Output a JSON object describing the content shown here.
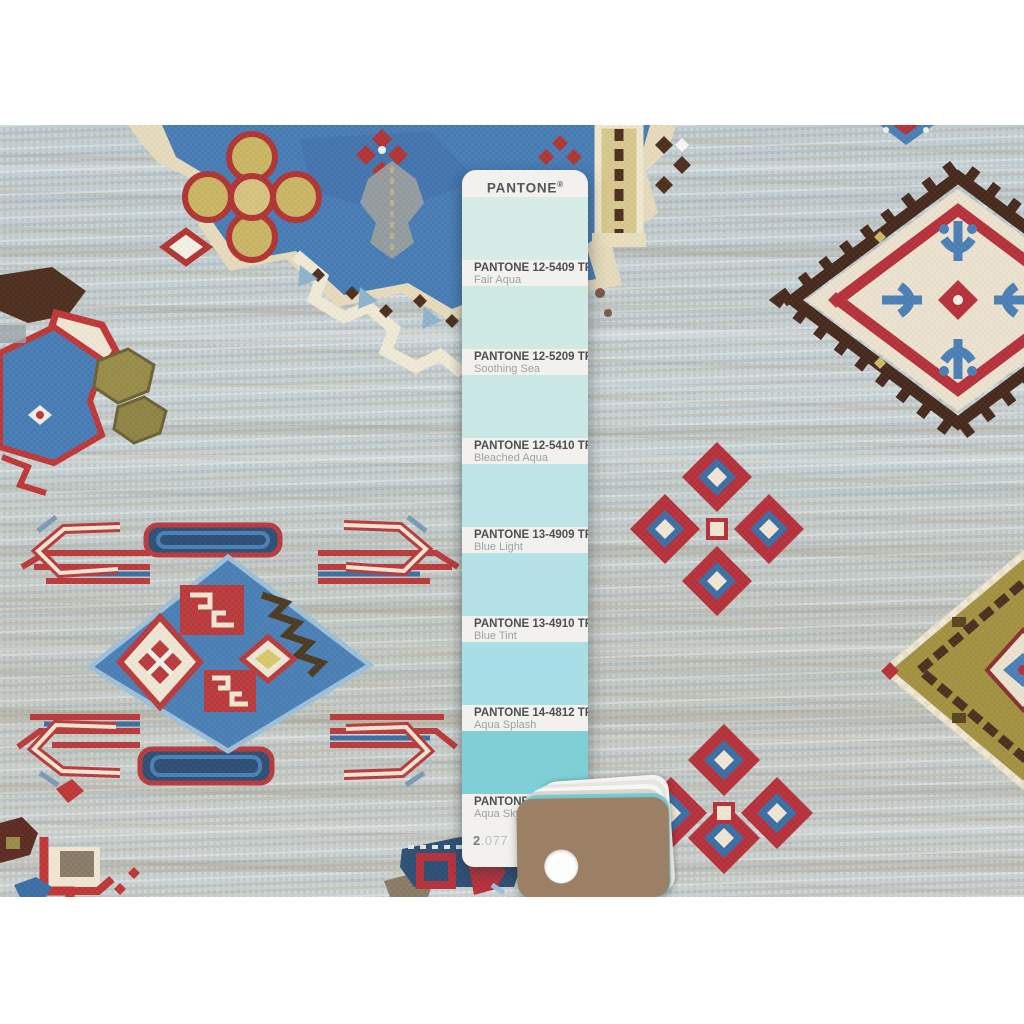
{
  "photo": {
    "subject_colors": {
      "rug_field": "#c6d0d2",
      "rug_blue": "#477cb4",
      "rug_navy": "#2d4e74",
      "rug_red": "#b5303a",
      "rug_cream": "#ece2cb",
      "rug_brown": "#4d2e1d",
      "rug_olive": "#a3913f",
      "rug_yellow": "#d0bb62"
    },
    "background_color": "#ffffff"
  },
  "pantone_card": {
    "brand": "PANTONE",
    "trademark": "®",
    "card_color": "#f2f1ee",
    "swatches": [
      {
        "code": "PANTONE 12-5409 TPG",
        "name": "Fair Aqua",
        "color": "#d7ece6"
      },
      {
        "code": "PANTONE 12-5209 TPG",
        "name": "Soothing Sea",
        "color": "#cfe9e4"
      },
      {
        "code": "PANTONE 12-5410 TPG",
        "name": "Bleached Aqua",
        "color": "#c8e7e5"
      },
      {
        "code": "PANTONE 13-4909 TPG",
        "name": "Blue Light",
        "color": "#bde4e7"
      },
      {
        "code": "PANTONE 13-4910 TPG",
        "name": "Blue Tint",
        "color": "#b3e1e6"
      },
      {
        "code": "PANTONE 14-4812 TPG",
        "name": "Aqua Splash",
        "color": "#a8dee6"
      },
      {
        "code": "PANTONE 14-48",
        "name": "Aqua Sky",
        "color": "#7ed0d6"
      }
    ],
    "page_code": {
      "prefix": "2",
      "separator": ".",
      "number": "077"
    }
  },
  "fan_deck": {
    "top_card_color": "#9c8065",
    "accent_edge_color": "#7fd0d6",
    "rivet_color": "#fdfdfc"
  }
}
